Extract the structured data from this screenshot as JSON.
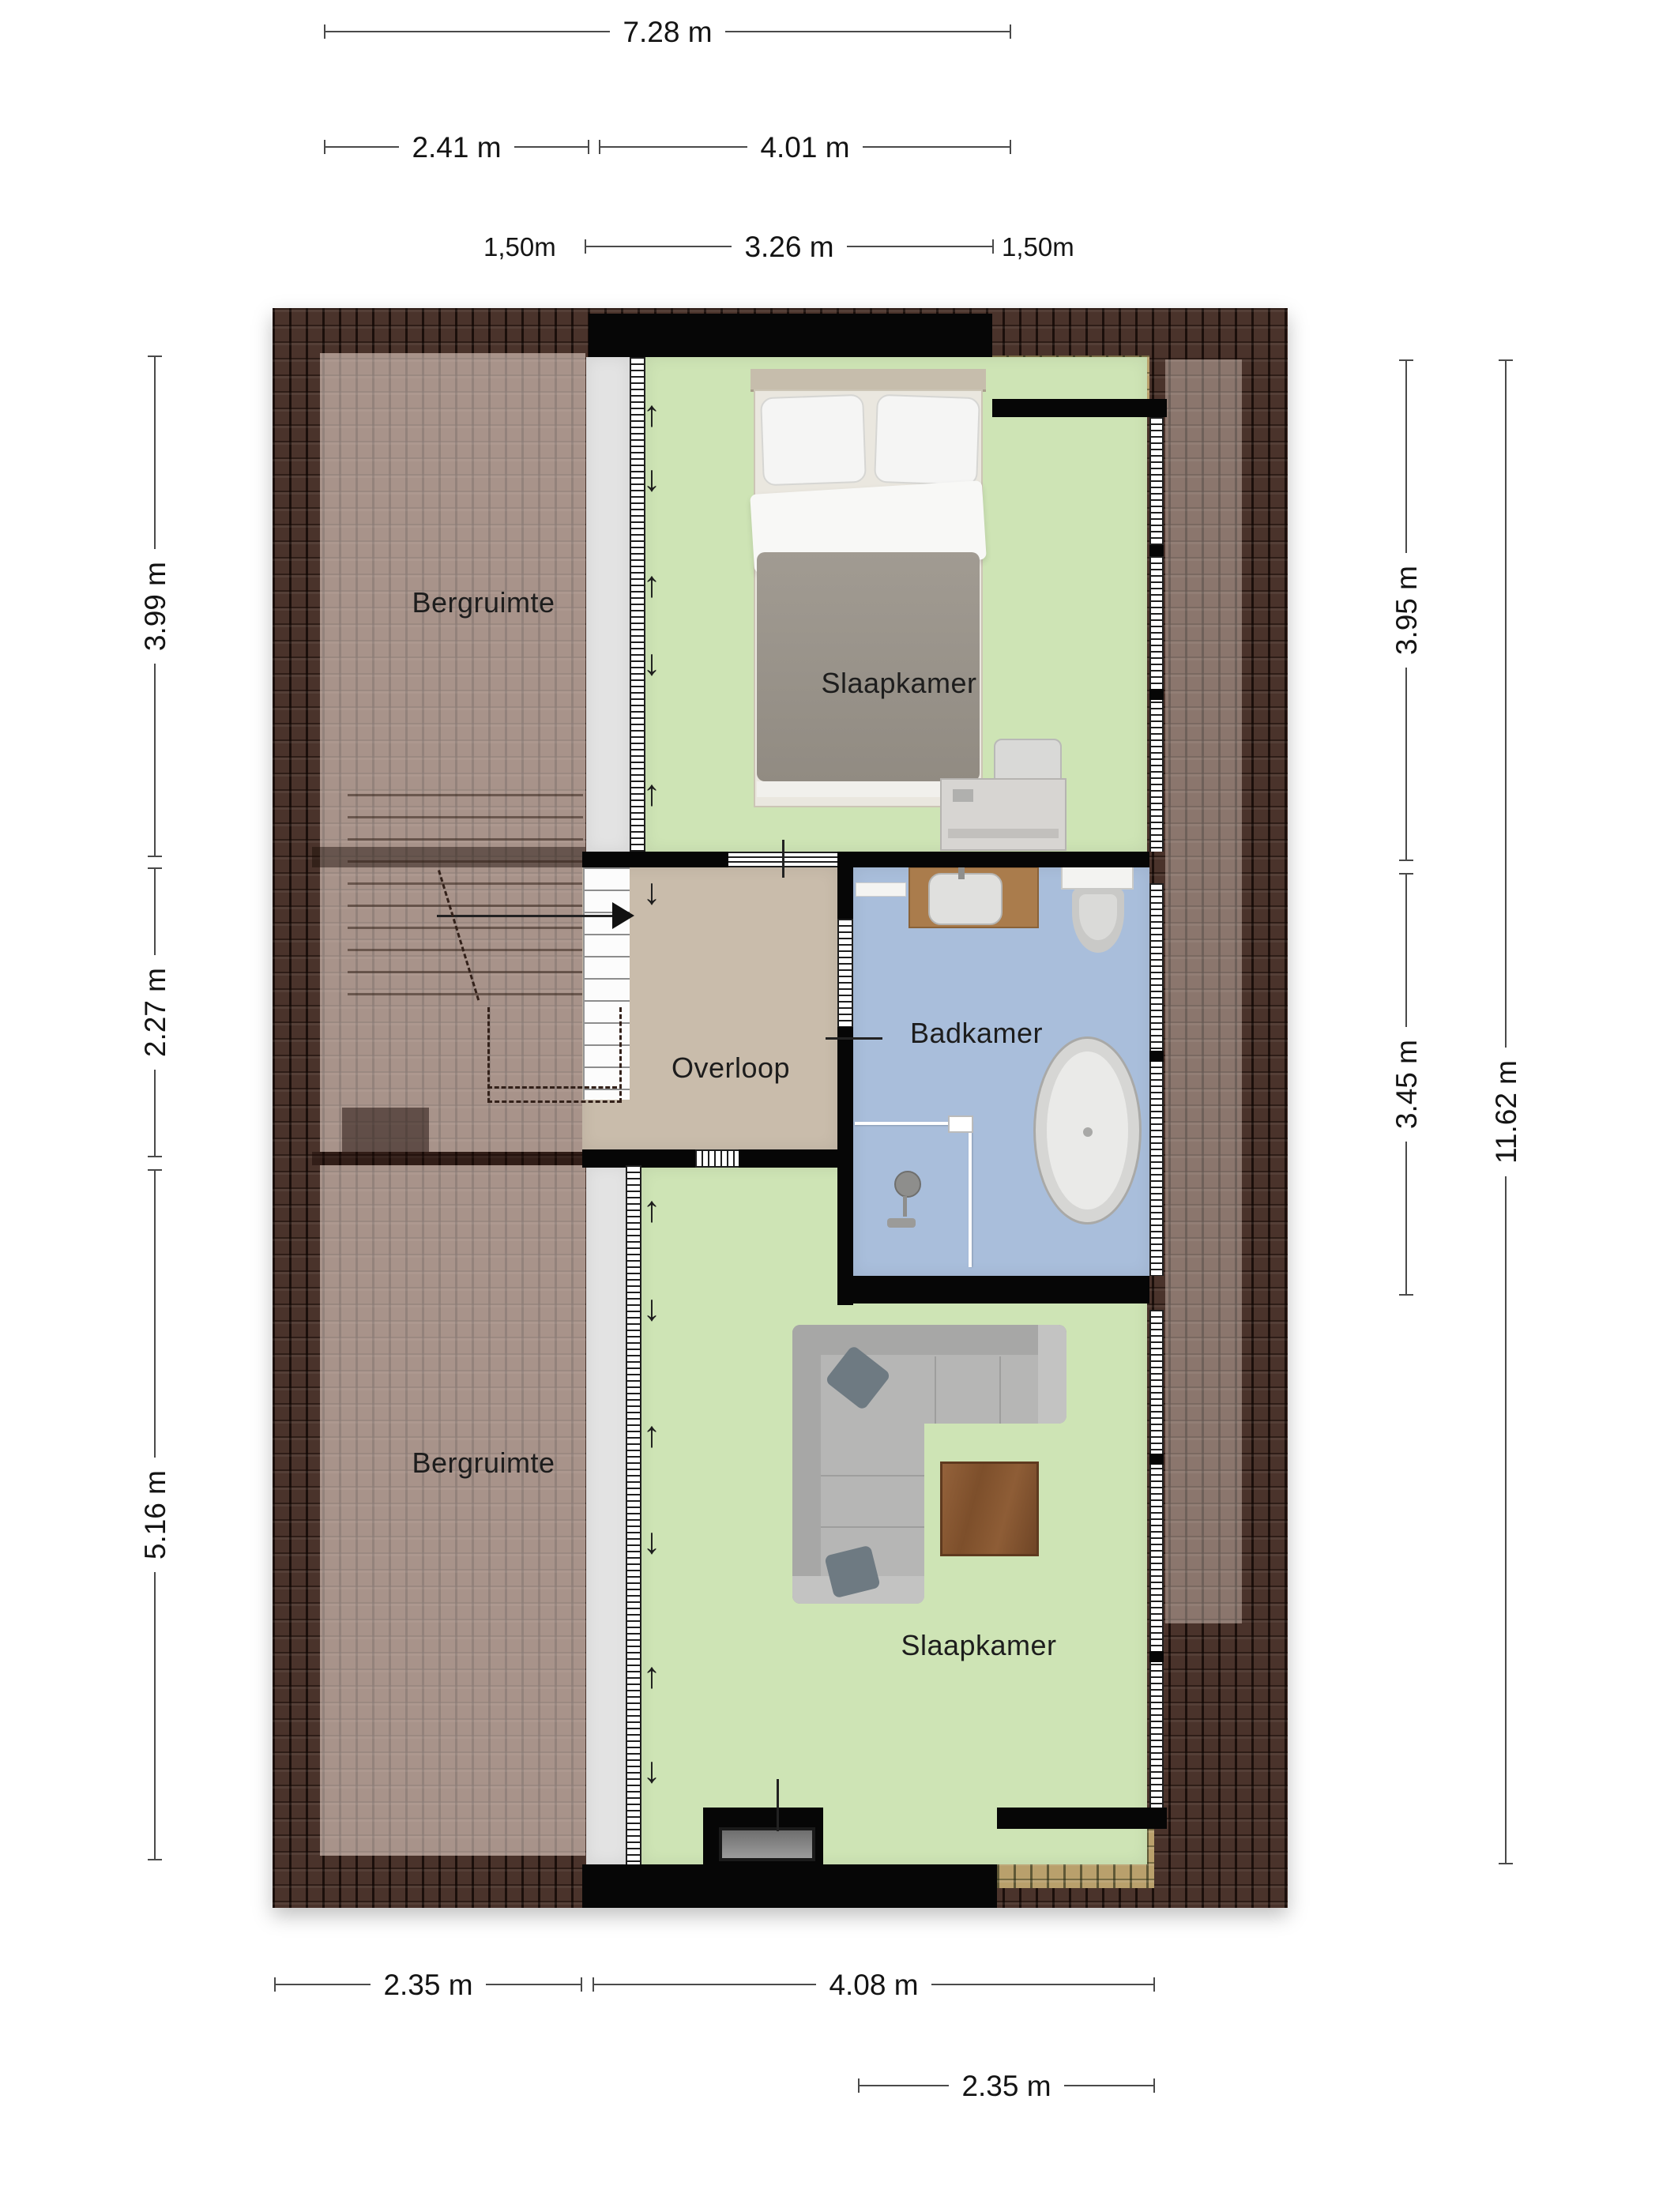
{
  "plan": {
    "rooms": {
      "bergruimte_top": {
        "label": "Bergruimte"
      },
      "slaapkamer_top": {
        "label": "Slaapkamer"
      },
      "overloop": {
        "label": "Overloop"
      },
      "badkamer": {
        "label": "Badkamer"
      },
      "bergruimte_bottom": {
        "label": "Bergruimte"
      },
      "slaapkamer_bottom": {
        "label": "Slaapkamer"
      }
    },
    "colors": {
      "floor_bedroom": "#cee4b5",
      "floor_bathroom": "#a9bedb",
      "floor_landing": "#c9bcab",
      "floor_low_headroom": "#e3e3e3",
      "roof_dark": "#4a332b",
      "dormer_tan": "#b9a06c",
      "wall": "#060606"
    }
  },
  "dimensions": {
    "top_total": "7.28 m",
    "top_left": "2.41 m",
    "top_right": "4.01 m",
    "headroom_left": "1,50m",
    "headroom_width": "3.26 m",
    "headroom_right": "1,50m",
    "side_left_top": "3.99 m",
    "side_left_mid": "2.27 m",
    "side_left_bottom": "5.16 m",
    "side_right_top": "3.95 m",
    "side_right_mid": "3.45 m",
    "side_right_total": "11.62 m",
    "bottom_left": "2.35 m",
    "bottom_mid": "4.08 m",
    "bottom_right": "2.35 m"
  },
  "icons": {
    "slope_arrow_up": "↑",
    "slope_arrow_down": "↓"
  }
}
